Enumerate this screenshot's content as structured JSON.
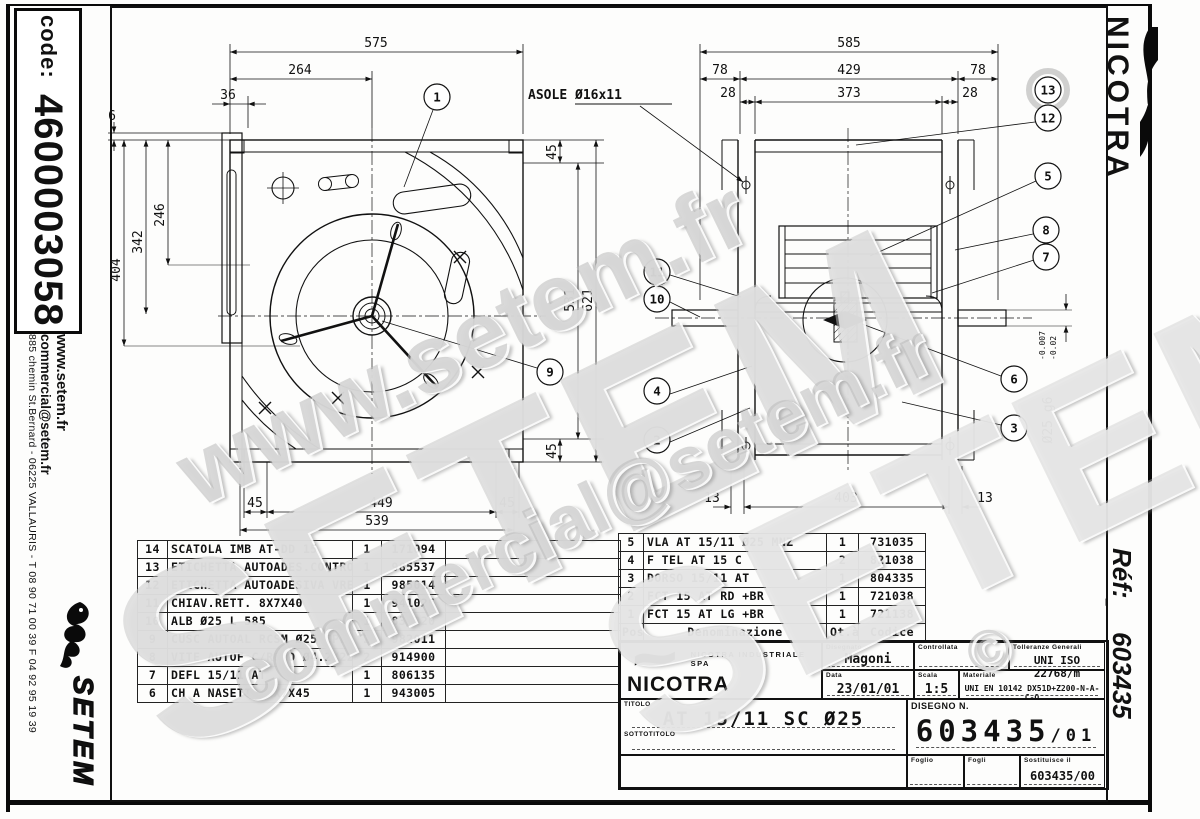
{
  "sheet": {
    "left_strip": {
      "code_label": "code:",
      "code_value": "4600003058",
      "website": "www.setem.fr",
      "email": "commercial@setem.fr",
      "address": "885 chemin St.Bernard  -  06225 VALLAURIS  -  T 08 90 71 00 39   F 04 92 95 19 39",
      "logo_text": "SETEM"
    },
    "right_strip": {
      "brand": "NICOTRA",
      "ref_label": "Réf:",
      "ref_value": "603435"
    }
  },
  "watermarks": {
    "w1": "www.setem.fr",
    "w2": "SETEM",
    "w3": "commercial@setem.fr",
    "w4": "SETEM",
    "w5": "©"
  },
  "left_view": {
    "balloon_1": "1",
    "balloon_9": "9",
    "dim_575": "575",
    "dim_264": "264",
    "dim_36": "36",
    "dim_6": "6",
    "dim_404": "404",
    "dim_342": "342",
    "dim_246": "246",
    "dim_531": "531",
    "dim_621": "621",
    "dim_45_tr": "45",
    "dim_45_br": "45",
    "dim_45_bl": "45",
    "dim_449": "449",
    "dim_45_bb": "45",
    "dim_539": "539"
  },
  "right_view": {
    "asole": "ASOLE Ø16x11",
    "dim_585": "585",
    "dim_78_l": "78",
    "dim_429": "429",
    "dim_78_r": "78",
    "dim_28_l": "28",
    "dim_373": "373",
    "dim_28_r": "28",
    "dim_13_l": "13",
    "dim_403": "403",
    "dim_13_r": "13",
    "shaft_dim": "Ø25 g6",
    "shaft_tol_upper": "-0.007",
    "shaft_tol_lower": "-0.02",
    "balloons": {
      "b13": "13",
      "b12": "12",
      "b5": "5",
      "b8": "8",
      "b7": "7",
      "b11": "11",
      "b10": "10",
      "b4": "4",
      "b2": "2",
      "b6": "6",
      "b3": "3"
    }
  },
  "parts_left": {
    "rows": [
      {
        "pos": "14",
        "name": "SCATOLA IMB AT-DD 15",
        "qty": "1",
        "code": "171094"
      },
      {
        "pos": "13",
        "name": "ETICHETTA AUTOADES.CONTROLLO",
        "qty": "1",
        "code": "985537"
      },
      {
        "pos": "12",
        "name": "ETICHETTA AUTOADESIVA VRE",
        "qty": "1",
        "code": "985014"
      },
      {
        "pos": "11",
        "name": "CHIAV.RETT. 8X7X40",
        "qty": "1",
        "code": "941026"
      },
      {
        "pos": "10",
        "name": "ALB Ø25 L 585",
        "qty": "1",
        "code": "830220"
      },
      {
        "pos": "9",
        "name": "CUSC AUTOAL RCSM Ø25 CPL",
        "qty": "2",
        "code": "982011"
      },
      {
        "pos": "8",
        "name": "VITE AUTOF C/ROND Ø4.2X22",
        "qty": "2",
        "code": "914900"
      },
      {
        "pos": "7",
        "name": "DEFL 15/11 AT",
        "qty": "1",
        "code": "806135"
      },
      {
        "pos": "6",
        "name": "CH A NASETTO 8X7X45",
        "qty": "1",
        "code": "943005"
      }
    ]
  },
  "parts_right": {
    "header": {
      "pos": "Pos.",
      "name": "Denominazione",
      "qty": "Qt.à",
      "code": "Codice"
    },
    "rows": [
      {
        "pos": "5",
        "name": "VLA AT 15/11 Ø25 MNZ",
        "qty": "1",
        "code": "731035"
      },
      {
        "pos": "4",
        "name": "F TEL AT 15 C",
        "qty": "2",
        "code": "821038"
      },
      {
        "pos": "3",
        "name": "DORSO 15/11 AT",
        "qty": "1",
        "code": "804335"
      },
      {
        "pos": "2",
        "name": "FCT 15 AT RD +BR",
        "qty": "1",
        "code": "721038"
      },
      {
        "pos": "1",
        "name": "FCT 15 AT LG +BR",
        "qty": "1",
        "code": "721138"
      }
    ]
  },
  "title_block": {
    "company": "NICOTRA INDUSTRIALE SPA",
    "brand": "NICOTRA",
    "drawn_label": "Disegnato",
    "drawn_value": "Magoni",
    "checked_label": "Controllata",
    "tolerance_label": "Tolleranze Generali",
    "tolerance_value": "UNI ISO 22768/m",
    "date_label": "Data",
    "date_value": "23/01/01",
    "scale_label": "Scala",
    "scale_value": "1:5",
    "material_label": "Materiale",
    "material_value": "UNI EN 10142 DX51D+Z200-N-A-C-O",
    "title_label": "TITOLO",
    "title_value": "AT 15/11 SC Ø25",
    "subtitle_label": "SOTTOTITOLO",
    "drawing_no_label": "DISEGNO N.",
    "drawing_no_value": "603435",
    "drawing_rev": "/01",
    "sheet_label": "Foglio",
    "sheets_label": "Fogli",
    "replaces_label": "Sostituisce il",
    "replaces_value": "603435/00"
  }
}
